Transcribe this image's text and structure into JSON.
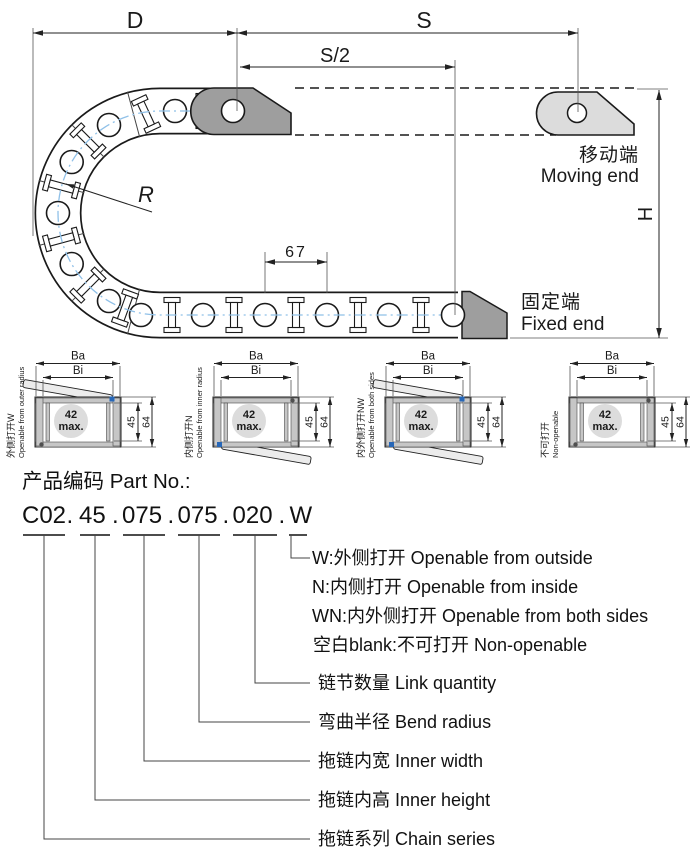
{
  "top_diagram": {
    "dim_d": "D",
    "dim_s": "S",
    "dim_s_half": "S/2",
    "dim_pitch": "67",
    "dim_h": "H",
    "dim_r": "R",
    "moving_end_cn": "移动端",
    "moving_end_en": "Moving end",
    "fixed_end_cn": "固定端",
    "fixed_end_en": "Fixed end"
  },
  "sections": {
    "dim_ba": "Ba",
    "dim_bi": "Bi",
    "dim_inner_h": "45",
    "dim_outer_h": "64",
    "bore": "42",
    "bore_max": "max.",
    "items": [
      {
        "cn": "外侧打开W",
        "en": "Openable from outer radius"
      },
      {
        "cn": "内侧打开N",
        "en": "Openable from inner radius"
      },
      {
        "cn": "内外侧打开NW",
        "en": "Openable from both sides"
      },
      {
        "cn": "不可打开",
        "en": "Non-openable"
      }
    ]
  },
  "part_no": {
    "title": "产品编码 Part No.:",
    "segments": [
      "C02",
      "45",
      "075",
      "075",
      "020",
      "W"
    ],
    "separator": ".",
    "legend": [
      "W:外侧打开 Openable from outside",
      "N:内侧打开 Openable from inside",
      "WN:内外侧打开 Openable from both sides",
      "空白blank:不可打开 Non-openable",
      "链节数量 Link quantity",
      "弯曲半径 Bend radius",
      "拖链内宽 Inner width",
      "拖链内高 Inner height",
      "拖链系列 Chain series"
    ]
  },
  "colors": {
    "accent_blue": "#1a5ca8",
    "centerline_blue": "#8fc0e8",
    "bracket_dark": "#9e9e9e",
    "bracket_light": "#dcdcdc",
    "wall_gray": "#c6c6c6"
  }
}
